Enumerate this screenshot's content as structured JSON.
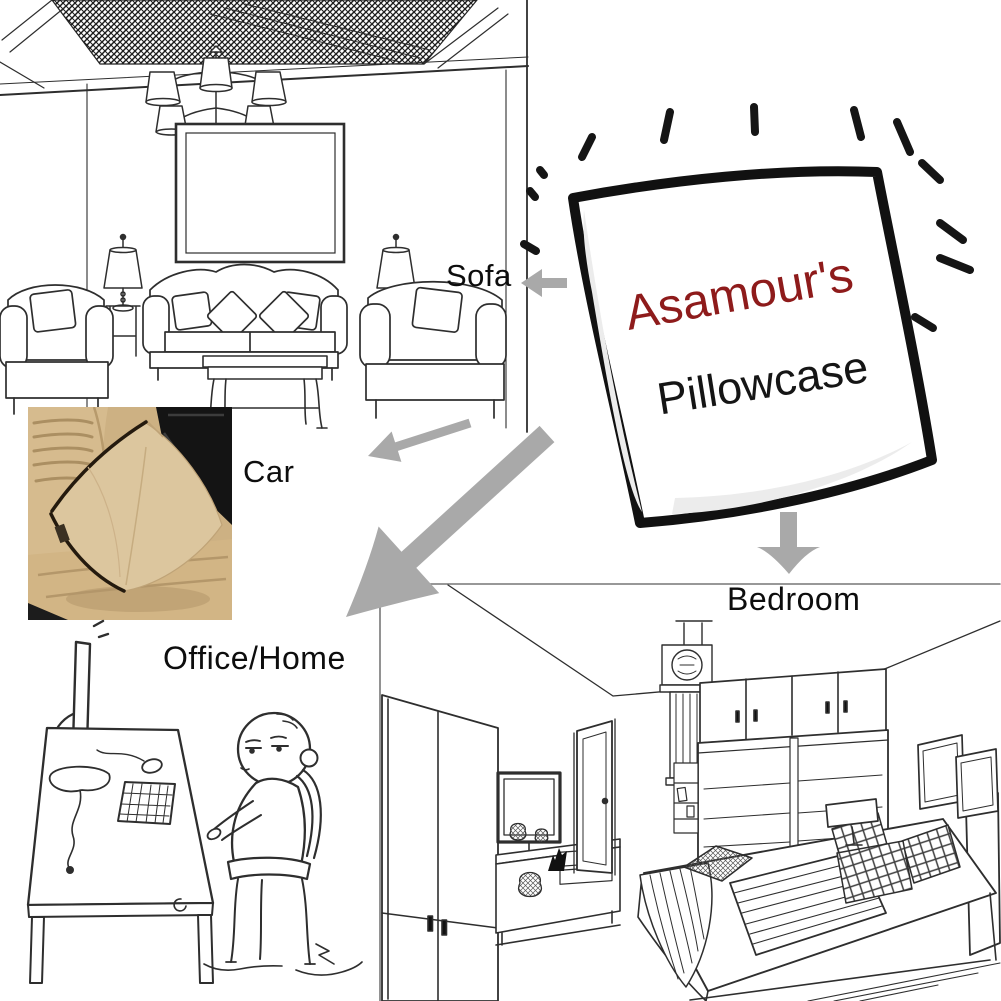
{
  "image": {
    "type": "product-usage-diagram",
    "background": "#ffffff"
  },
  "product": {
    "brand": "Asamour's",
    "name": "Pillowcase"
  },
  "labels": {
    "sofa": "Sofa",
    "car": "Car",
    "office_home": "Office/Home",
    "bedroom": "Bedroom"
  },
  "colors": {
    "brand_text": "#8e1b1b",
    "product_text": "#151515",
    "label_text": "#0d0d0d",
    "arrow_gray": "#a9a9a9",
    "line_art": "#2e2e2e",
    "pillow_outline": "#111111",
    "ceiling_hatch": "#1c1c1c",
    "car_seat_beige": "#d2b585",
    "car_pillow_beige": "#dcc69e",
    "car_console_black": "#141414",
    "car_buckle_red": "#c23f3f"
  },
  "icons": [
    {
      "name": "arrow-left-icon",
      "points_to": "Sofa"
    },
    {
      "name": "arrow-down-left-small-icon",
      "points_to": "Car"
    },
    {
      "name": "arrow-down-left-large-icon",
      "points_to": "Office/Home"
    },
    {
      "name": "arrow-down-icon",
      "points_to": "Bedroom"
    },
    {
      "name": "sparkle-dashes-icon",
      "points_to": "Pillowcase emphasis"
    }
  ],
  "scenes": [
    {
      "id": "living-room",
      "label": "Sofa",
      "media": "line-drawing"
    },
    {
      "id": "car-seat",
      "label": "Car",
      "media": "photo"
    },
    {
      "id": "office",
      "label": "Office/Home",
      "media": "line-drawing"
    },
    {
      "id": "bedroom",
      "label": "Bedroom",
      "media": "line-drawing"
    }
  ]
}
